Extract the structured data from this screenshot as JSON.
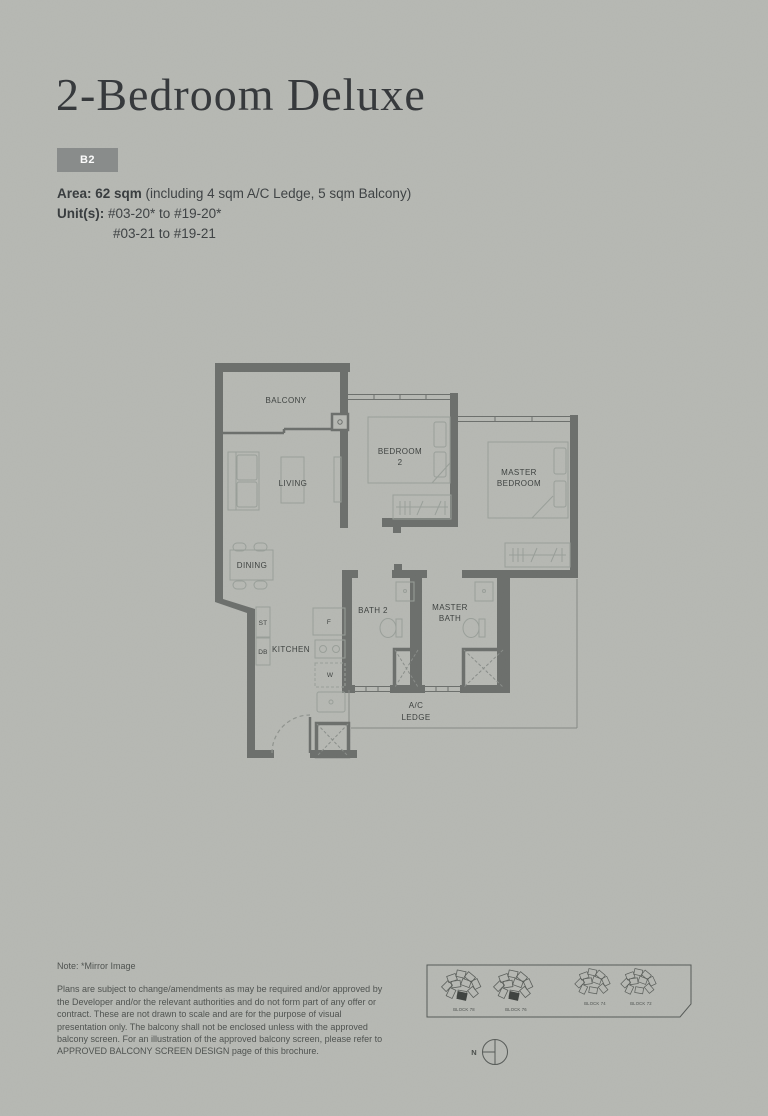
{
  "header": {
    "title": "2-Bedroom Deluxe",
    "badge": "B2",
    "area_label": "Area: 62 sqm",
    "area_rest": " (including 4 sqm A/C Ledge, 5 sqm Balcony)",
    "units_label": "Unit(s):",
    "units_line1": "#03-20* to #19-20*",
    "units_line2": "#03-21 to #19-21"
  },
  "floorplan": {
    "rooms": {
      "balcony": "BALCONY",
      "living": "LIVING",
      "dining": "DINING",
      "kitchen": "KITCHEN",
      "bedroom2_l1": "BEDROOM",
      "bedroom2_l2": "2",
      "master_l1": "MASTER",
      "master_l2": "BEDROOM",
      "bath2": "BATH 2",
      "masterbath_l1": "MASTER",
      "masterbath_l2": "BATH",
      "acledge_l1": "A/C",
      "acledge_l2": "LEDGE"
    },
    "fixtures": {
      "store": "ST",
      "db": "DB",
      "fridge": "F",
      "washer": "W"
    }
  },
  "keyplan": {
    "blocks": [
      "BLOCK 78",
      "BLOCK 76",
      "BLOCK 74",
      "BLOCK 72"
    ],
    "north_label": "N"
  },
  "note": {
    "mirror": "Note: *Mirror Image",
    "lines": [
      "Plans are subject to change/amendments as may be required and/or approved by",
      "the Developer and/or the relevant authorities and do not form part of any offer or",
      "contract. These are not drawn to scale and are for the purpose of visual",
      "presentation only. The balcony shall not be enclosed unless with the approved",
      "balcony screen. For an illustration of the approved balcony screen, please refer to",
      "APPROVED BALCONY SCREEN DESIGN page of this brochure."
    ]
  },
  "colors": {
    "background": "#b7b9b4",
    "wall": "#6c6f6c",
    "furniture_line": "#9aa09a",
    "text": "#3c403e",
    "badge_bg": "#898c8b",
    "badge_text": "#ffffff",
    "highlight_unit": "#3e423f"
  }
}
